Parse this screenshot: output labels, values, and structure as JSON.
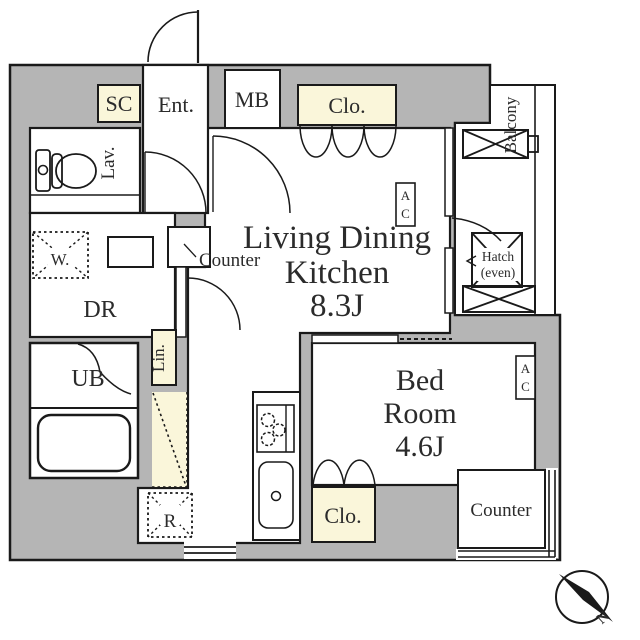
{
  "colors": {
    "wall_fill": "#b5b5b5",
    "storage_fill": "#faf6da",
    "line": "#1a1a1a",
    "text": "#2b2b2b",
    "room_fill": "#ffffff"
  },
  "rooms": {
    "ldk": {
      "line1": "Living Dining",
      "line2": "Kitchen",
      "line3": "8.3J"
    },
    "bedroom": {
      "line1": "Bed",
      "line2": "Room",
      "line3": "4.6J"
    },
    "entrance": {
      "label": "Ent."
    },
    "lavatory": {
      "label": "Lav."
    },
    "dressing_room": {
      "label": "DR"
    },
    "unit_bath": {
      "label": "UB"
    },
    "balcony": {
      "label": "Balcony"
    }
  },
  "storage": {
    "shoe_closet": "SC",
    "meter_box": "MB",
    "closet_ldk": "Clo.",
    "linen": "Lin.",
    "closet_bedroom": "Clo."
  },
  "fixtures": {
    "washer": "W.",
    "fridge": "R",
    "kitchen_counter": "Counter",
    "bay_counter": "Counter",
    "ac_letter1": "A",
    "ac_letter2": "C",
    "hatch_line1": "Hatch",
    "hatch_line2": "(even)"
  },
  "compass": {
    "north": "N"
  }
}
